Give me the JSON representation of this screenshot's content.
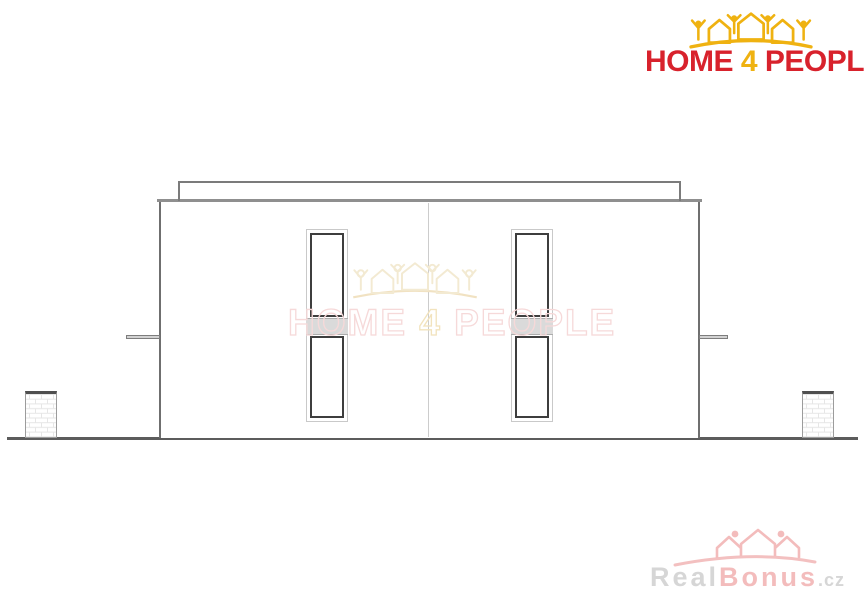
{
  "brand": {
    "name": "HOME 4 PEOPLE",
    "home": "HOME",
    "four": "4",
    "people": "PEOPLE",
    "colors": {
      "red": "#d8222c",
      "yellow": "#efb211"
    }
  },
  "center_watermark": {
    "home": "HOME",
    "four": "4",
    "people": "PEOPLE",
    "colors": {
      "outline_rose": "#f6d9d9",
      "outline_gold": "#f2e3bd",
      "icon": "#f3ead2"
    }
  },
  "footer_watermark": {
    "real": "Real",
    "bonus": "Bonus",
    "cz": ".cz",
    "colors": {
      "gray": "#d6d6d6",
      "pink": "#f3bcbc"
    }
  },
  "drawing": {
    "type": "house elevation (semi-detached, flat roof)",
    "colors": {
      "wall_outline": "#6f6f6f",
      "wall_top_line": "#8f8f8f",
      "parapet_line": "#7b7b7b",
      "ground_line": "#5c5c5c",
      "unit_divider": "#cccccc",
      "window_frame_dark": "#3e3e3e",
      "window_frame_light": "#c9c9c9",
      "spandrel_band": "#dadada",
      "pillar_cap": "#4f4f4f",
      "brick_line": "#e6e6e6"
    }
  }
}
